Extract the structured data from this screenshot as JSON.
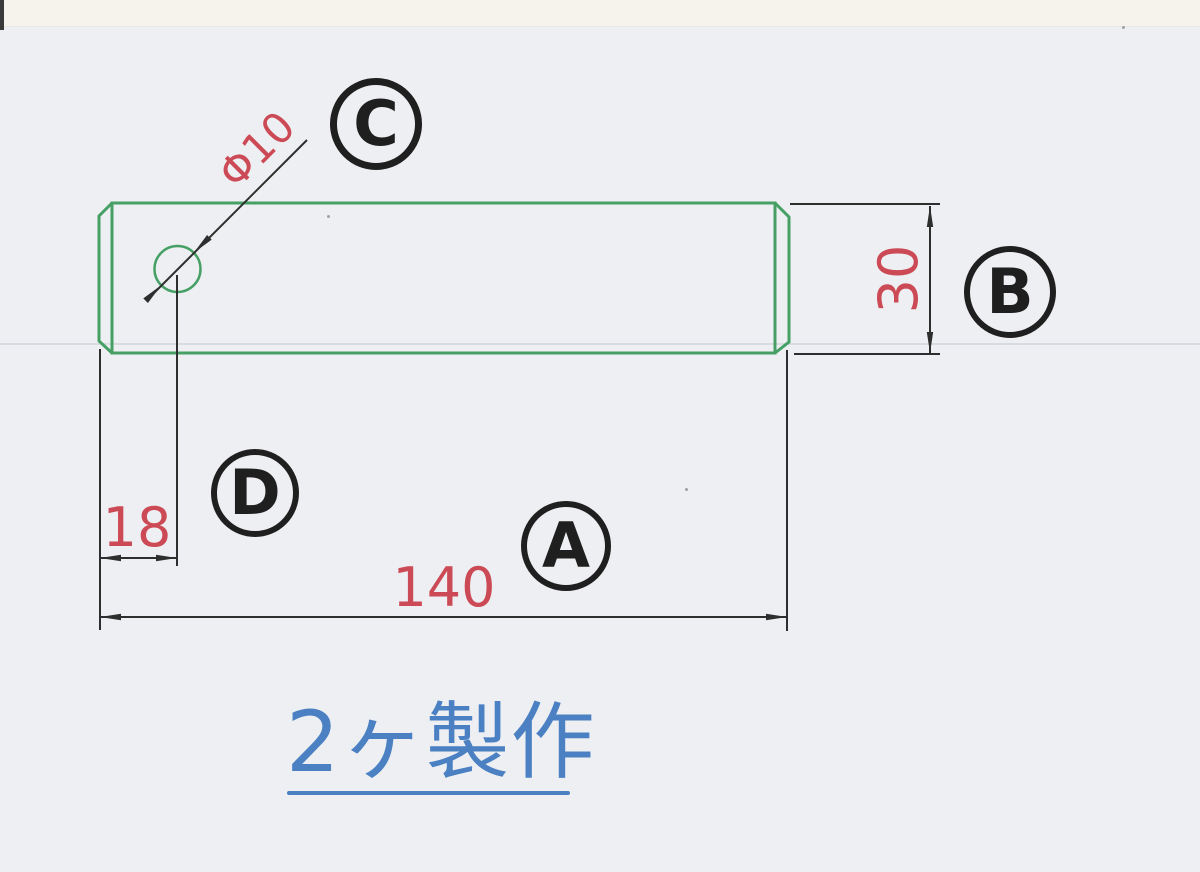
{
  "colors": {
    "paper": "#edeff2",
    "paper_top": "#f6f3ec",
    "green": "#46a065",
    "red": "#cc4a55",
    "blue": "#4b80c3",
    "line": "#2e2e2e"
  },
  "dims": {
    "hole_diameter": "Φ10",
    "height": "30",
    "hole_offset": "18",
    "length": "140"
  },
  "balloons": {
    "a": "A",
    "b": "B",
    "c": "C",
    "d": "D"
  },
  "note": {
    "text": "2ヶ製作"
  },
  "drawing_data": {
    "type": "mechanical-part-drawing",
    "part": "rectangular bar with chamfered ends and one through hole",
    "length": 140,
    "height": 30,
    "hole_diameter": 10,
    "hole_center_from_left": 18,
    "quantity": 2
  }
}
